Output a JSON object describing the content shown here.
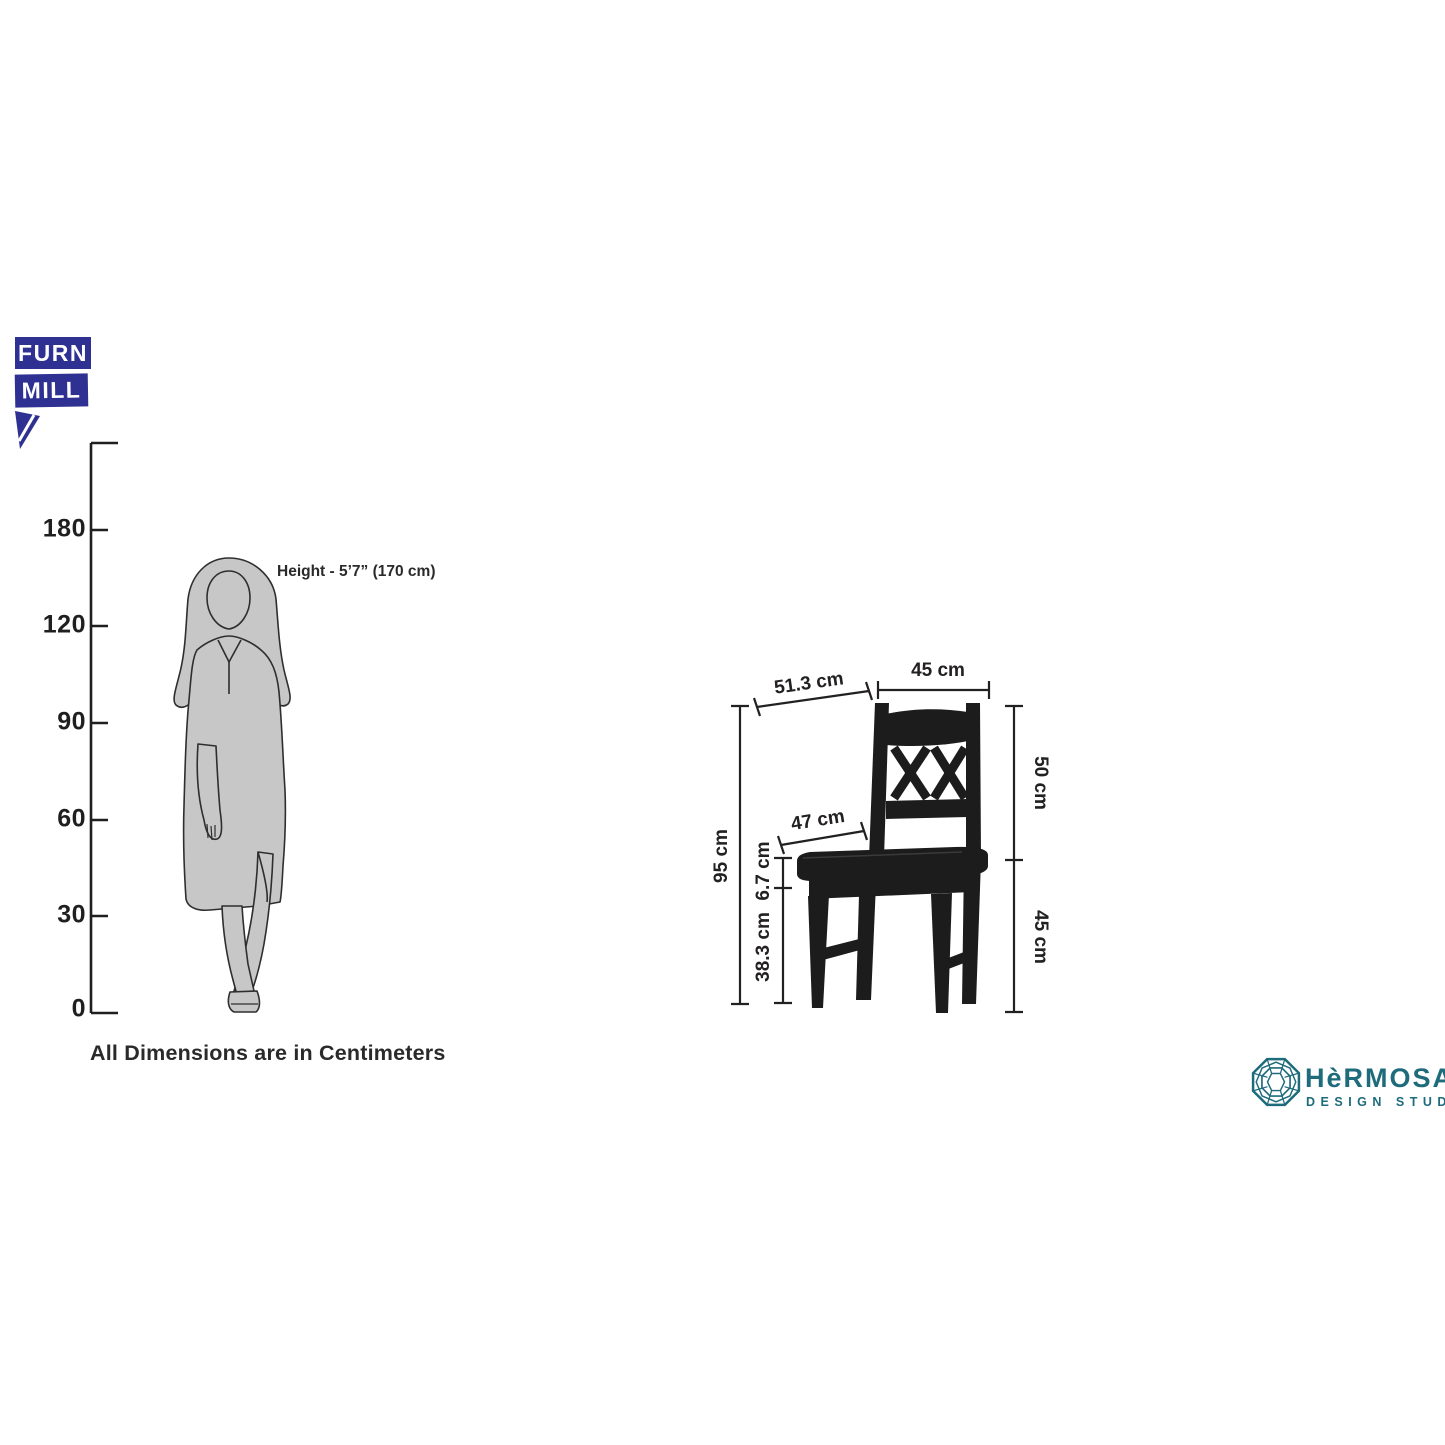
{
  "brand": {
    "name_line1": "FURN",
    "name_line2": "MILL"
  },
  "scale": {
    "ticks": [
      "180",
      "120",
      "90",
      "60",
      "30",
      "0"
    ],
    "note": "All Dimensions are in Centimeters"
  },
  "person": {
    "height_label": "Height - 5’7” (170 cm)"
  },
  "chair": {
    "dims": {
      "top_depth": "51.3 cm",
      "top_width": "45 cm",
      "back_height": "50 cm",
      "seat_to_floor": "45 cm",
      "overall_height": "95 cm",
      "seat_thickness": "6.7 cm",
      "under_seat": "38.3 cm",
      "seat_depth": "47 cm"
    }
  },
  "studio": {
    "name": "HèRMOSA",
    "tagline": "DESIGN STUDIO"
  },
  "colors": {
    "brand_blue": "#2E3192",
    "studio_teal": "#1E6B7C",
    "chair_black": "#1C1C1C",
    "silhouette_gray": "#C7C7C7",
    "line_dark": "#232020"
  }
}
